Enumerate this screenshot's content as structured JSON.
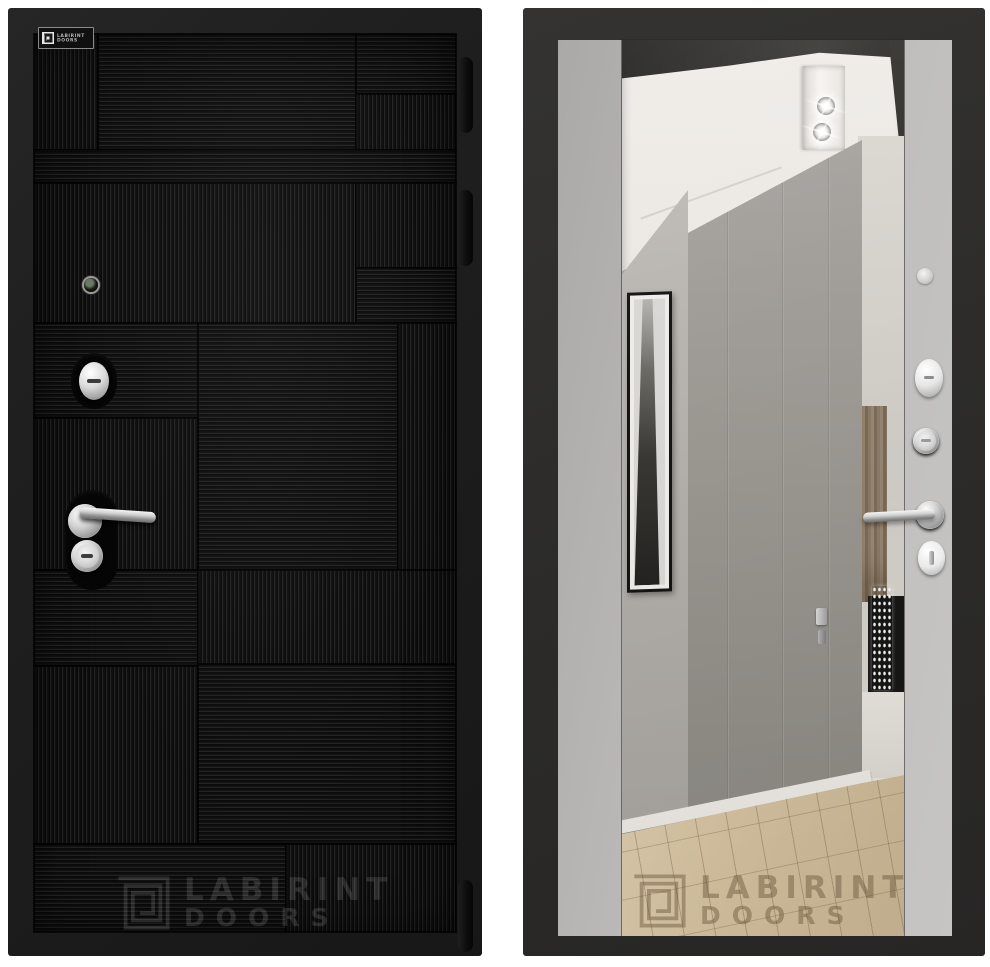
{
  "page": {
    "background": "#ffffff",
    "subject": "entrance door product photo, front and back panels"
  },
  "brand": {
    "line1": "LABIRINT",
    "line2": "DOORS"
  },
  "left_door": {
    "description": "front panel, black ribbed patchwork finish",
    "finish_hex": "#121212",
    "hardware": [
      "peephole",
      "upper cylinder escutcheon",
      "lever handle",
      "lock cylinder"
    ]
  },
  "right_door": {
    "description": "back panel, soft grey finish with tall mirror",
    "finish_hex": "#bcbbb9",
    "frame_hex": "#2d2c2a",
    "hardware": [
      "door viewer cap",
      "oval escutcheon",
      "cylinder",
      "lever handle",
      "thumbturn"
    ]
  }
}
